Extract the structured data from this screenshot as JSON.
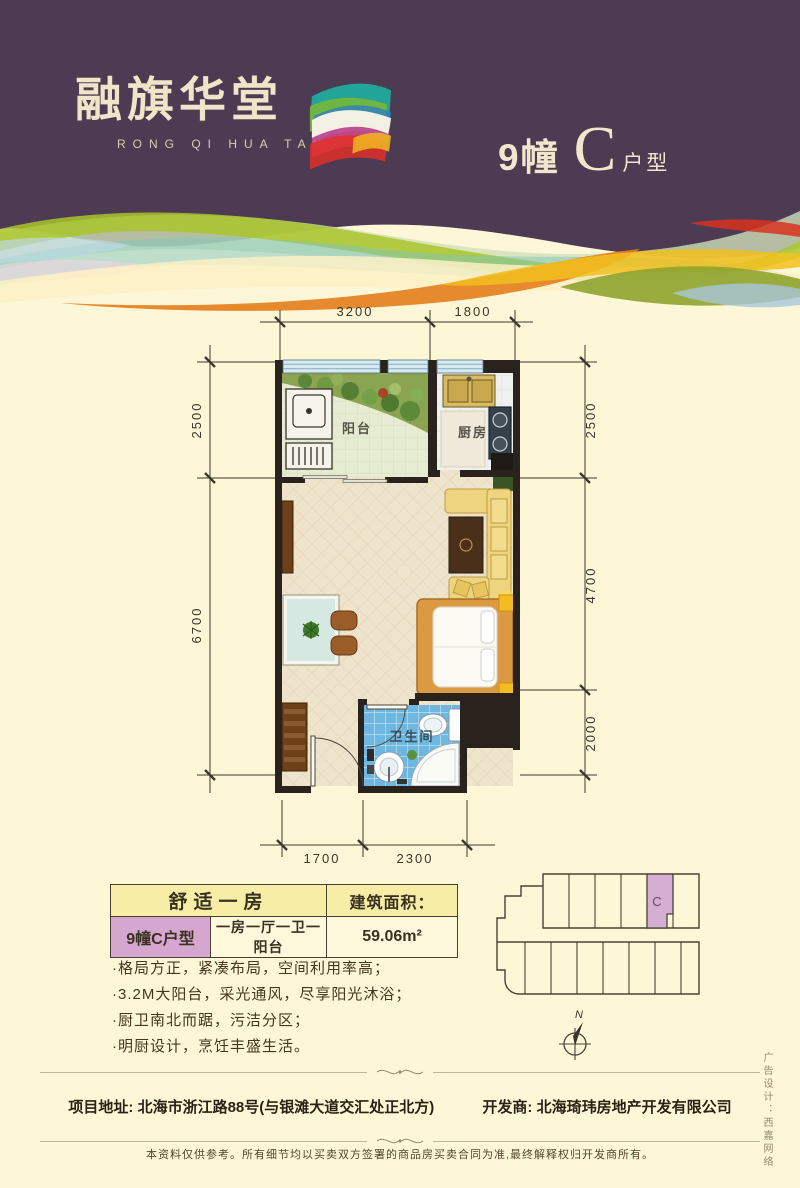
{
  "header": {
    "logo_cn": "融旗华堂",
    "logo_en": "RONG QI HUA TANG",
    "building": "9幢",
    "unit_letter": "C",
    "unit_suffix": "户型"
  },
  "floorplan": {
    "dim_top": [
      "3200",
      "1800"
    ],
    "dim_left": [
      "2500",
      "6700"
    ],
    "dim_right": [
      "2500",
      "4700",
      "2000"
    ],
    "dim_bottom": [
      "1700",
      "2300"
    ],
    "room_balcony": "阳台",
    "room_kitchen": "厨房",
    "room_bath": "卫生间"
  },
  "info": {
    "title": "舒适一房",
    "area_label": "建筑面积：",
    "unit_name": "9幢C户型",
    "layout": "一房一厅一卫一阳台",
    "area_value": "59.06m²",
    "bullets": [
      "·格局方正，紧凑布局，空间利用率高；",
      "·3.2M大阳台，采光通风，尽享阳光沐浴；",
      "·厨卫南北而踞，污洁分区；",
      "·明厨设计，烹饪丰盛生活。"
    ]
  },
  "keyplan": {
    "unit_label": "C",
    "north_label": "N"
  },
  "footer": {
    "address": "项目地址: 北海市浙江路88号(与银滩大道交汇处正北方)",
    "developer": "开发商: 北海琦玮房地产开发有限公司",
    "disclaimer": "本资料仅供参考。所有细节均以买卖双方签署的商品房买卖合同为准,最终解释权归开发商所有。",
    "credit": "广告设计：西嘉网络"
  },
  "colors": {
    "header_purple": "#4c3b53",
    "page_cream": "#fdf7d8",
    "highlight_purple": "#d5a6d0",
    "table_yellow": "#f6eea6",
    "bath_blue": "#6db7e0",
    "wall_dark": "#2a231d"
  }
}
